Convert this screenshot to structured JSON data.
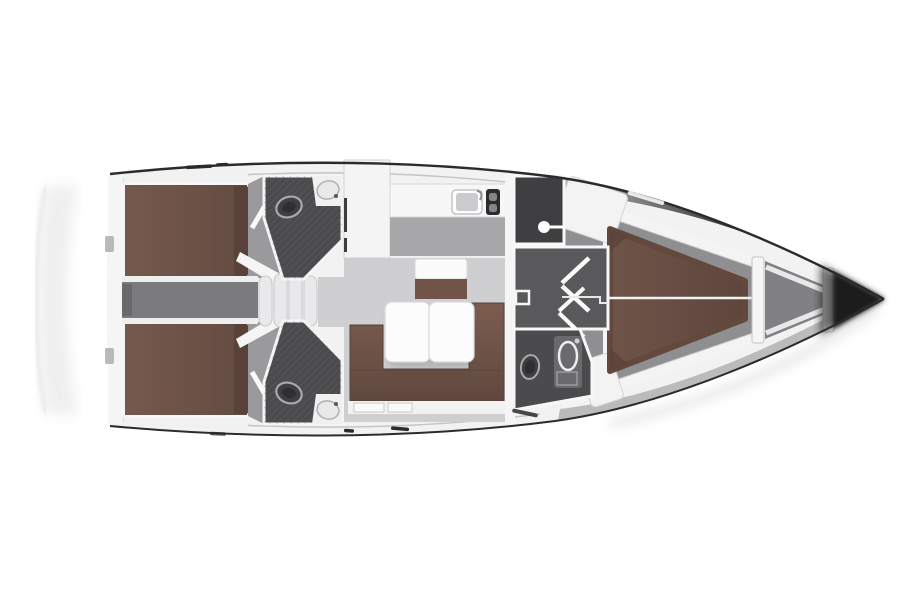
{
  "diagram_type": "sailing-yacht-interior-floorplan-top-view",
  "orientation": {
    "bow": "right",
    "stern": "left"
  },
  "colors": {
    "page_bg": "#ffffff",
    "hull_fill": "#f2f2f3",
    "hull_edge": "#2b2b2d",
    "deck_line": "#c3c3c5",
    "shadow_band_top": "#1f1f21",
    "shadow_band_bottom": "#9c9c9e",
    "bow_cone": "#161618",
    "stern_arc": "#dcdcde",
    "stern_shadow": "#ebebed",
    "berth": "#6d5247",
    "berth_dark": "#594239",
    "vberth_light": "#6f5448",
    "vberth_dark": "#5e463d",
    "sofa_light": "#7b5d4f",
    "sofa_dark": "#5f483e",
    "sofa_outline": "#55413a",
    "bench_brown": "#6f5447",
    "table": "#fcfcfd",
    "table_edge": "#d9d9db",
    "counter": "#f7f7f8",
    "white_block": "#f4f4f5",
    "salon_floor": "#cfcfd1",
    "galley_floor": "#a7a7a9",
    "cabin_floor": "#8f8f91",
    "corridor": "#7b7b7d",
    "wedge_floor": "#9a9a9c",
    "anchor_floor": "#808082",
    "wet_floor": "#4b4b4d",
    "wet_floor_dark": "#3f3f41",
    "vestibule": "#59595b",
    "hatch_line": "#6f6f71",
    "fixture_light": "#ececee",
    "fixture_mid": "#a9a9ab",
    "vanity": "#6a6a6c",
    "wall_white": "#f5f5f6",
    "wall_line": "#c6c6c8",
    "step_tread": "#e9e9eb",
    "window_dash": "#2a2a2c"
  },
  "layout": {
    "rooms": [
      {
        "id": "aft-cabin-top",
        "furniture": [
          "double-berth",
          "pillow-strip",
          "cabin-door"
        ]
      },
      {
        "id": "aft-cabin-bottom",
        "furniture": [
          "double-berth",
          "pillow-strip",
          "cabin-door"
        ]
      },
      {
        "id": "aft-head-top",
        "furniture": [
          "toilet",
          "sink"
        ]
      },
      {
        "id": "aft-head-bottom",
        "furniture": [
          "toilet",
          "sink"
        ]
      },
      {
        "id": "engine-corridor",
        "furniture": []
      },
      {
        "id": "companionway",
        "furniture": [
          "steps-4-treads"
        ]
      },
      {
        "id": "nav-area",
        "furniture": [
          "cabinet"
        ]
      },
      {
        "id": "galley",
        "furniture": [
          "counter",
          "sink",
          "stove"
        ]
      },
      {
        "id": "salon",
        "furniture": [
          "folding-table",
          "u-sofa",
          "bench-seat"
        ]
      },
      {
        "id": "shower-room",
        "furniture": [
          "shower"
        ]
      },
      {
        "id": "vestibule",
        "furniture": [
          "double-door-swings",
          "step-marker"
        ]
      },
      {
        "id": "forward-head",
        "furniture": [
          "toilet",
          "vanity-sink"
        ]
      },
      {
        "id": "forward-cabin",
        "furniture": [
          "v-berth",
          "locker-top",
          "locker-bottom"
        ]
      },
      {
        "id": "anchor-locker",
        "furniture": [
          "bulkhead-near",
          "bulkhead-far",
          "braces"
        ]
      }
    ]
  }
}
